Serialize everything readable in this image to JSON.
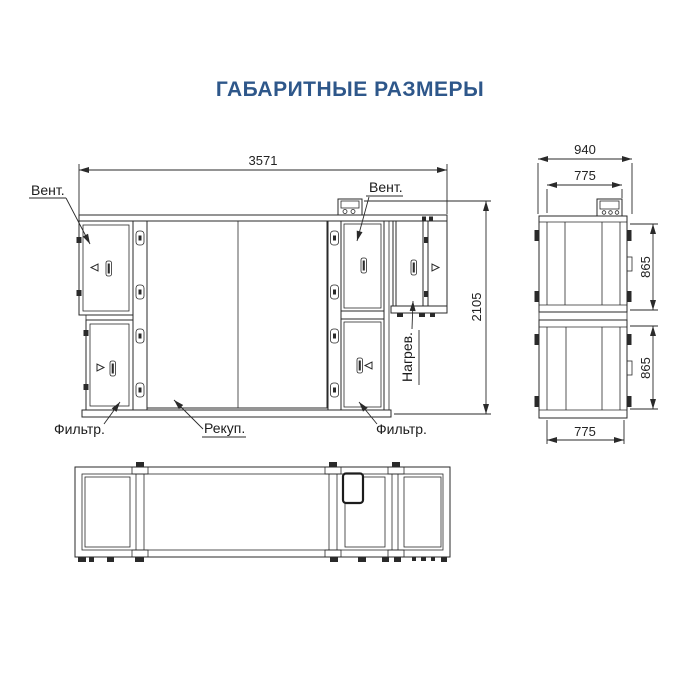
{
  "title": "ГАБАРИТНЫЕ РАЗМЕРЫ",
  "colors": {
    "line_color": "#2a2a2a",
    "title_color": "#2e578a"
  },
  "front_view": {
    "dim_overall_width_mm": "3571",
    "dim_overall_height_mm": "2105",
    "label_fan_left": "Вент.",
    "label_fan_right": "Вент.",
    "label_filter_left": "Фильтр.",
    "label_filter_right": "Фильтр.",
    "label_recuperator": "Рекуп.",
    "label_heater": "Нагрев."
  },
  "side_view": {
    "dim_overall_depth_mm": "940",
    "dim_case_width_top_mm": "775",
    "dim_case_width_bottom_mm": "775",
    "dim_section_height_top_mm": "865",
    "dim_section_height_bottom_mm": "865"
  }
}
